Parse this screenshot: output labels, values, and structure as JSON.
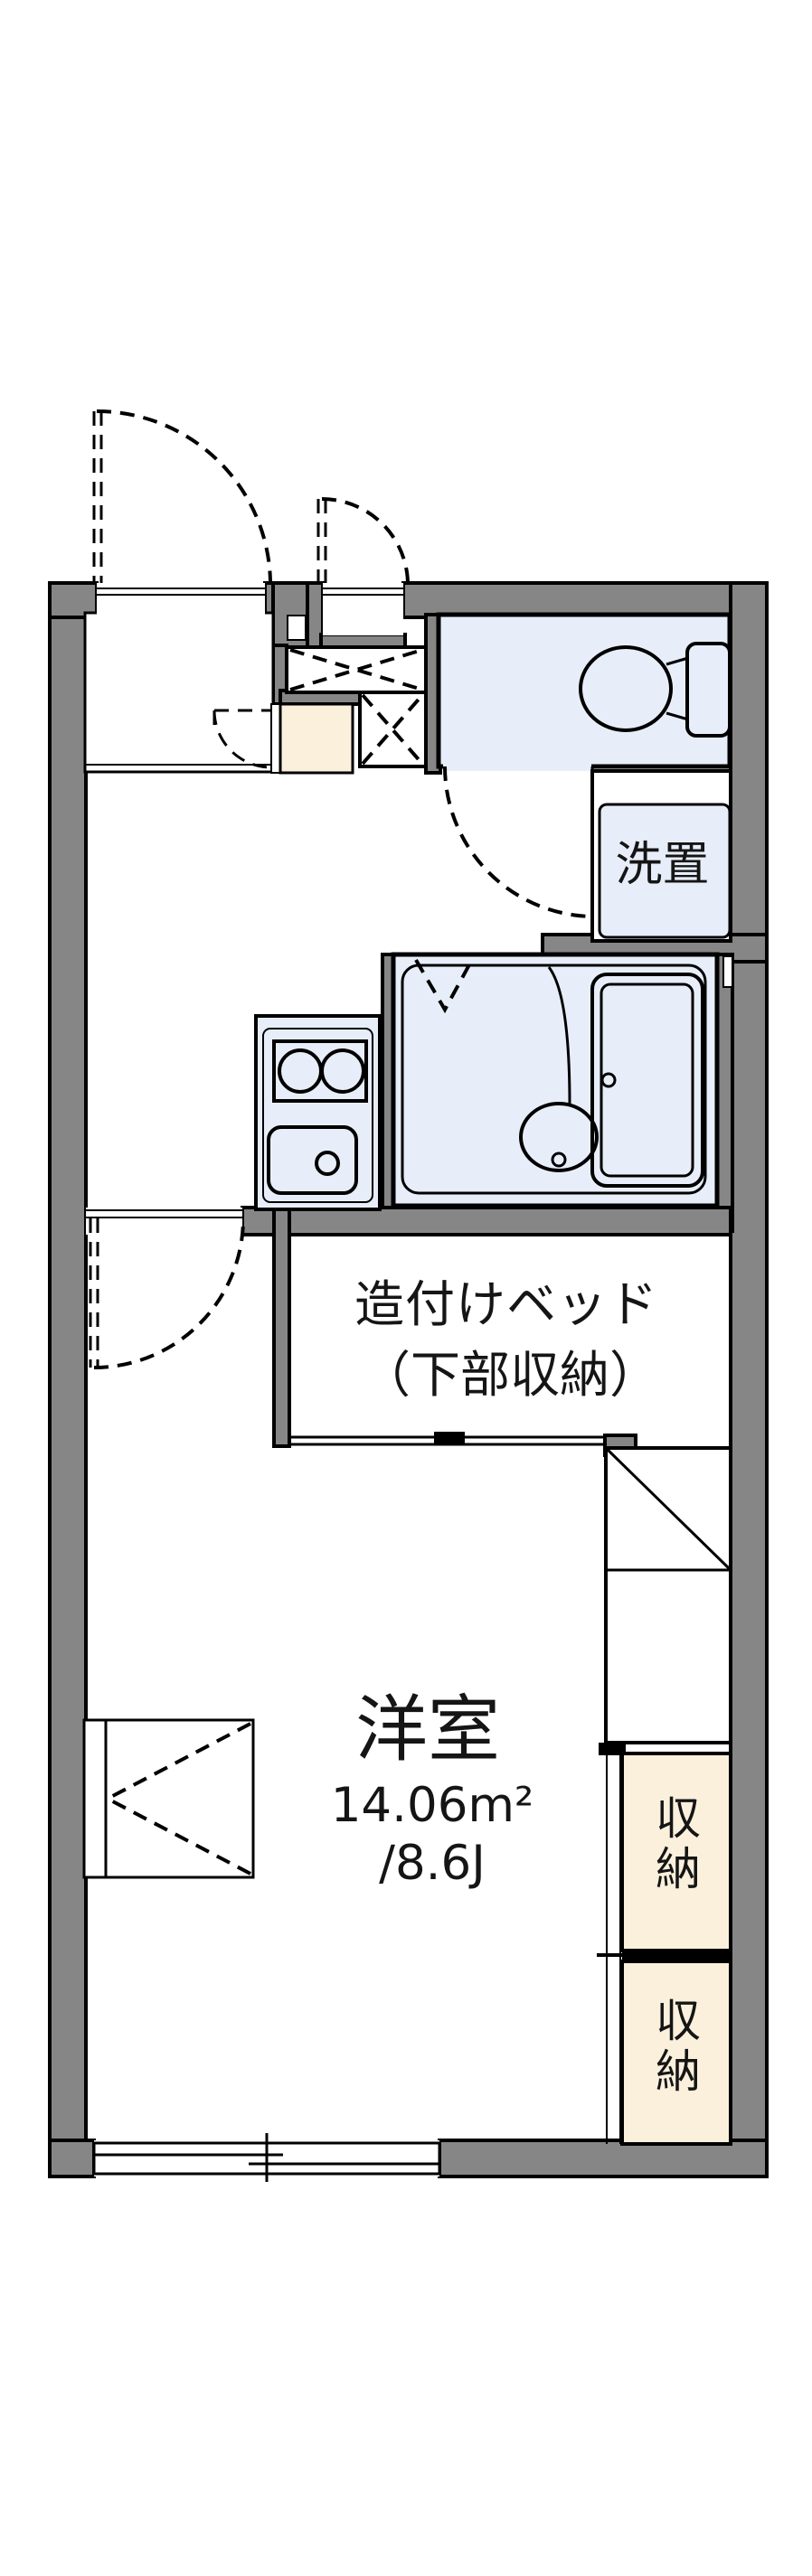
{
  "floorplan": {
    "labels": {
      "washer": "洗置",
      "bed_line1": "造付けベッド",
      "bed_line2": "（下部収納）",
      "room": "洋室",
      "area_m2": "14.06m²",
      "area_jo": "/8.6J",
      "closet_upper": "収納",
      "closet_lower": "収納"
    },
    "colors": {
      "wall_gray": "#868686",
      "room_blue": "#e8eef9",
      "closet_cream": "#fbf0dc"
    }
  }
}
